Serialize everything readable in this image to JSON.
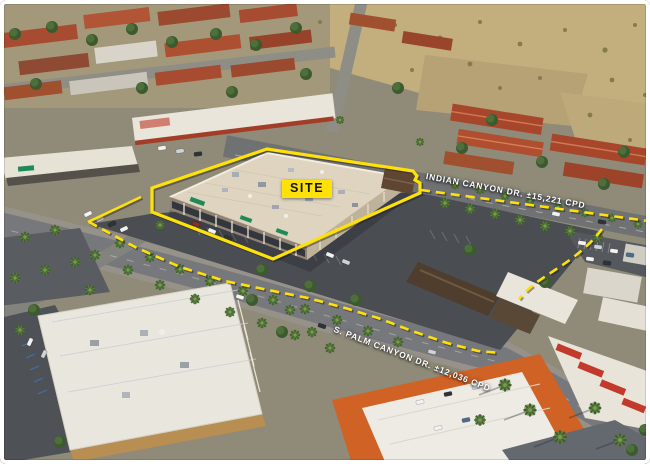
{
  "annotations": {
    "site_label": "SITE",
    "streets": [
      {
        "name": "Indian Canyon Dr.",
        "traffic_count": "±15,221 CPD",
        "label": "INDIAN CANYON DR. ±15,221 CPD"
      },
      {
        "name": "S. Palm Canyon Dr.",
        "traffic_count": "±12,036 CPD",
        "label": "S. PALM CANYON DR. ±12,036 CPD"
      }
    ],
    "colors": {
      "highlight": "#FFE10A",
      "street_label_text": "#FFFFFF",
      "site_label_text": "#141414"
    }
  }
}
